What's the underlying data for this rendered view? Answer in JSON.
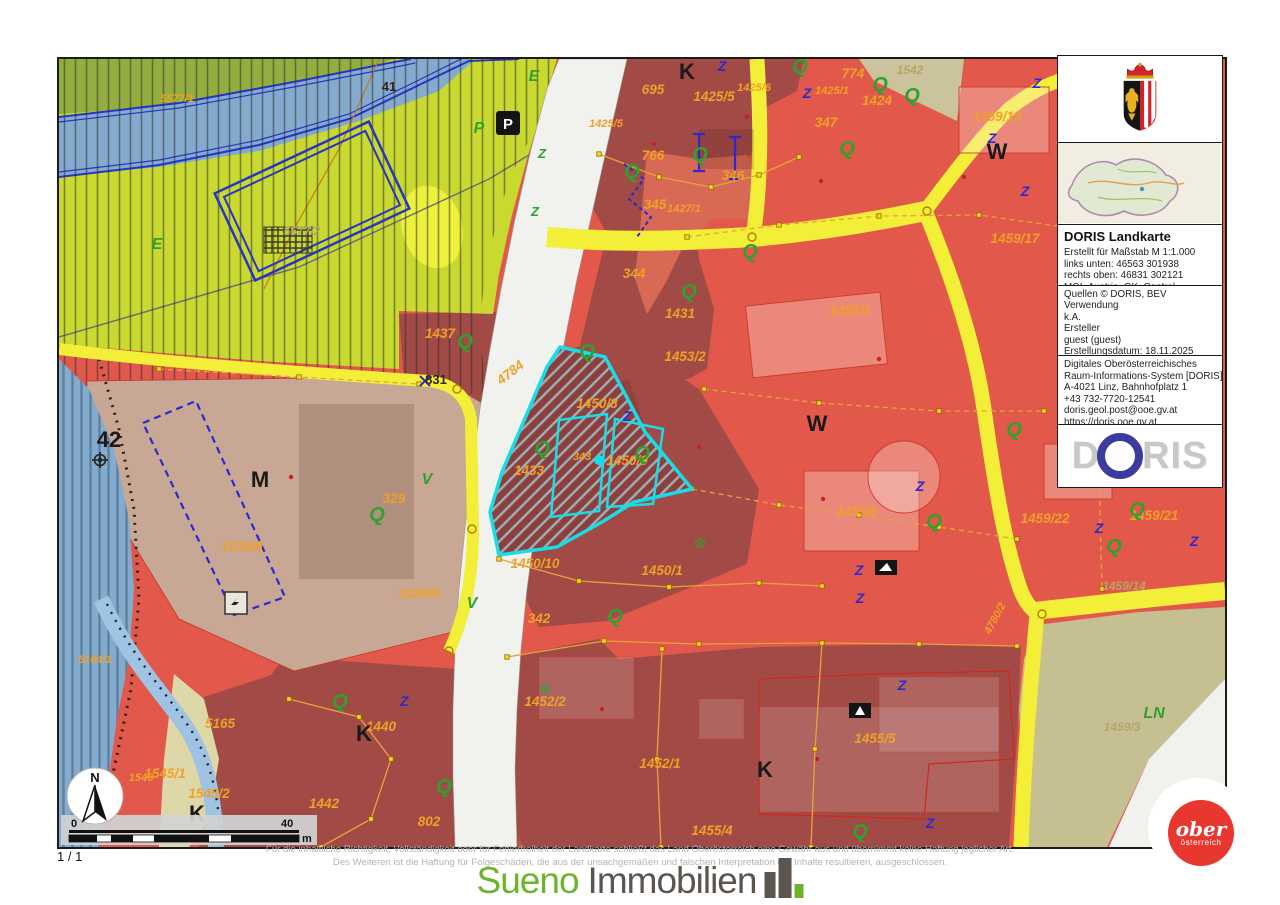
{
  "page": {
    "indicator": "1 / 1"
  },
  "panel": {
    "title": "DORIS Landkarte",
    "meta_lines": [
      "Erstellt für Maßstab M 1:1.000",
      "links unten: 46563 301938",
      "rechts oben: 46831 302121",
      "MGI_Austria_GK_Central"
    ],
    "source_lines": [
      "Quellen © DORIS, BEV",
      "Verwendung",
      "k.A.",
      "Ersteller",
      "guest (guest)",
      "Erstellungsdatum: 18.11.2025"
    ],
    "org_lines": [
      "Digitales Oberösterreichisches",
      "Raum-Informations-System [DORIS]",
      "A-4021 Linz, Bahnhofplatz 1",
      "+43 732-7720-12541",
      "doris.geol.post@ooe.gv.at",
      "https://doris.ooe.gv.at"
    ],
    "logo": {
      "d": "D",
      "ris": "RIS"
    }
  },
  "footer": {
    "disclaimer_line1": "Für die inhaltliche Richtigkeit, Vollständigkeit oder für Fehlerfreiheit der Landkarte schließt das Land Oberösterreich eine Gewähr aus und übernimmt keine Haftung jeglicher Art.",
    "disclaimer_line2": "Des Weiteren ist die Haftung für Folgeschäden, die aus der unsachgemäßen und falschen Interpretation der Inhalte resultieren, ausgeschlossen.",
    "watermark_primary": "Sueno",
    "watermark_secondary": "Immobilien"
  },
  "corner_logo": {
    "line1": "ober",
    "line2": "österreich"
  },
  "scalebar": {
    "start": "0",
    "end": "40",
    "unit": "m"
  },
  "north": {
    "label": "N"
  },
  "map": {
    "colors": {
      "light_parcel_red": "#e2584a",
      "dark_parcel_red": "#a24b46",
      "land_green": "#c9d92f",
      "water_blue": "#84abcd",
      "beige": "#c8a795",
      "olive_field": "#c5bf92",
      "road_yellow": "#f3ef39",
      "road_white": "#f1f1ee",
      "highlight_cyan": "#17dde8",
      "parcel_label_orange": "#f0a028",
      "symbol_green": "#2fa12f",
      "symbol_blue": "#2a2ad0",
      "crest_red": "#d2232a",
      "corner_logo_red": "#e8372e",
      "sueno_green": "#6bb52c"
    },
    "labels": [
      {
        "t": "5577/1",
        "x": 118,
        "y": 43,
        "c": "ps"
      },
      {
        "t": "695",
        "x": 594,
        "y": 35,
        "c": "p"
      },
      {
        "t": "1425/5",
        "x": 655,
        "y": 42,
        "c": "p"
      },
      {
        "t": "1425/5",
        "x": 547,
        "y": 68,
        "c": "ps"
      },
      {
        "t": "1425/6",
        "x": 695,
        "y": 32,
        "c": "ps"
      },
      {
        "t": "1425/1",
        "x": 773,
        "y": 35,
        "c": "ps"
      },
      {
        "t": "774",
        "x": 794,
        "y": 19,
        "c": "p"
      },
      {
        "t": "1424",
        "x": 818,
        "y": 46,
        "c": "p"
      },
      {
        "t": "347",
        "x": 767,
        "y": 68,
        "c": "p"
      },
      {
        "t": "766",
        "x": 594,
        "y": 101,
        "c": "p"
      },
      {
        "t": "346",
        "x": 674,
        "y": 121,
        "c": "p"
      },
      {
        "t": "345",
        "x": 596,
        "y": 150,
        "c": "p"
      },
      {
        "t": "1427/1",
        "x": 625,
        "y": 153,
        "c": "ps"
      },
      {
        "t": "344",
        "x": 575,
        "y": 219,
        "c": "p"
      },
      {
        "t": "1431",
        "x": 621,
        "y": 259,
        "c": "p"
      },
      {
        "t": "1453/2",
        "x": 626,
        "y": 302,
        "c": "p"
      },
      {
        "t": "1455/1",
        "x": 791,
        "y": 256,
        "c": "p"
      },
      {
        "t": "1437",
        "x": 381,
        "y": 279,
        "c": "p"
      },
      {
        "t": "4784",
        "x": 454,
        "y": 317,
        "c": "p",
        "r": -38
      },
      {
        "t": "1450/8",
        "x": 538,
        "y": 349,
        "c": "p"
      },
      {
        "t": "343",
        "x": 523,
        "y": 401,
        "c": "ps"
      },
      {
        "t": "1450/9",
        "x": 568,
        "y": 406,
        "c": "p"
      },
      {
        "t": "1433",
        "x": 470,
        "y": 416,
        "c": "p"
      },
      {
        "t": "1459/15",
        "x": 938,
        "y": 62,
        "c": "p"
      },
      {
        "t": "1459/17",
        "x": 956,
        "y": 184,
        "c": "p"
      },
      {
        "t": "329",
        "x": 335,
        "y": 444,
        "c": "p"
      },
      {
        "t": "1439/9",
        "x": 183,
        "y": 492,
        "c": "p"
      },
      {
        "t": "1439/8",
        "x": 360,
        "y": 539,
        "c": "p"
      },
      {
        "t": "1450/10",
        "x": 476,
        "y": 509,
        "c": "p"
      },
      {
        "t": "1450/1",
        "x": 603,
        "y": 516,
        "c": "p"
      },
      {
        "t": "342",
        "x": 480,
        "y": 564,
        "c": "p"
      },
      {
        "t": "1455/6",
        "x": 798,
        "y": 457,
        "c": "p"
      },
      {
        "t": "1459/22",
        "x": 986,
        "y": 464,
        "c": "p"
      },
      {
        "t": "1459/21",
        "x": 1095,
        "y": 461,
        "c": "p"
      },
      {
        "t": "4780/2",
        "x": 939,
        "y": 561,
        "c": "ps",
        "r": -62
      },
      {
        "t": "5164/1",
        "x": 36,
        "y": 604,
        "c": "ps"
      },
      {
        "t": "5165",
        "x": 161,
        "y": 669,
        "c": "p"
      },
      {
        "t": "1545/1",
        "x": 106,
        "y": 719,
        "c": "p"
      },
      {
        "t": "1545/2",
        "x": 150,
        "y": 739,
        "c": "p"
      },
      {
        "t": "1546",
        "x": 82,
        "y": 722,
        "c": "ps"
      },
      {
        "t": "1442",
        "x": 265,
        "y": 749,
        "c": "p"
      },
      {
        "t": "1440",
        "x": 322,
        "y": 672,
        "c": "p"
      },
      {
        "t": "802",
        "x": 370,
        "y": 767,
        "c": "p"
      },
      {
        "t": "1452/2",
        "x": 486,
        "y": 647,
        "c": "p"
      },
      {
        "t": "1452/1",
        "x": 601,
        "y": 709,
        "c": "p"
      },
      {
        "t": "1455/5",
        "x": 816,
        "y": 684,
        "c": "p"
      },
      {
        "t": "1455/4",
        "x": 653,
        "y": 776,
        "c": "p"
      },
      {
        "t": "5577/2",
        "x": 243,
        "y": 176,
        "c": "ol"
      },
      {
        "t": "1542",
        "x": 851,
        "y": 15,
        "c": "ol"
      },
      {
        "t": "1459/14",
        "x": 1065,
        "y": 531,
        "c": "ol"
      },
      {
        "t": "1459/3",
        "x": 1063,
        "y": 672,
        "c": "ol"
      },
      {
        "t": "831",
        "x": 377,
        "y": 325,
        "c": "dk"
      },
      {
        "t": "41",
        "x": 330,
        "y": 32,
        "c": "dk"
      },
      {
        "t": "K",
        "x": 628,
        "y": 20,
        "c": "blk"
      },
      {
        "t": "W",
        "x": 938,
        "y": 100,
        "c": "blk"
      },
      {
        "t": "W",
        "x": 758,
        "y": 372,
        "c": "blk"
      },
      {
        "t": "M",
        "x": 201,
        "y": 428,
        "c": "blk"
      },
      {
        "t": "K",
        "x": 305,
        "y": 682,
        "c": "blk"
      },
      {
        "t": "K",
        "x": 706,
        "y": 718,
        "c": "blk"
      },
      {
        "t": "K",
        "x": 138,
        "y": 762,
        "c": "blk",
        "s": 18
      },
      {
        "t": "42",
        "x": 50,
        "y": 388,
        "c": "blk",
        "s": 16
      },
      {
        "t": "E",
        "x": 98,
        "y": 190,
        "c": "grn",
        "s": 18
      },
      {
        "t": "E",
        "x": 475,
        "y": 22,
        "c": "grn",
        "s": 14
      },
      {
        "t": "P",
        "x": 420,
        "y": 74,
        "c": "grn",
        "s": 16
      },
      {
        "t": "V",
        "x": 368,
        "y": 425,
        "c": "grn",
        "s": 14
      },
      {
        "t": "V",
        "x": 413,
        "y": 549,
        "c": "grn",
        "s": 14
      },
      {
        "t": "LN",
        "x": 1095,
        "y": 659,
        "c": "grn",
        "s": 17
      },
      {
        "t": "P",
        "x": 449,
        "y": 70,
        "c": "pw"
      },
      {
        "t": "Q",
        "x": 741,
        "y": 14,
        "c": "q"
      },
      {
        "t": "Q",
        "x": 821,
        "y": 32,
        "c": "q"
      },
      {
        "t": "Q",
        "x": 853,
        "y": 43,
        "c": "q",
        "s": 15
      },
      {
        "t": "Q",
        "x": 788,
        "y": 96,
        "c": "q"
      },
      {
        "t": "Q",
        "x": 641,
        "y": 102,
        "c": "q"
      },
      {
        "t": "Q",
        "x": 573,
        "y": 119,
        "c": "q"
      },
      {
        "t": "Q",
        "x": 691,
        "y": 199,
        "c": "q"
      },
      {
        "t": "Q",
        "x": 630,
        "y": 239,
        "c": "q"
      },
      {
        "t": "Q",
        "x": 528,
        "y": 299,
        "c": "q"
      },
      {
        "t": "Q",
        "x": 483,
        "y": 396,
        "c": "q"
      },
      {
        "t": "Q",
        "x": 583,
        "y": 401,
        "c": "q"
      },
      {
        "t": "Q",
        "x": 955,
        "y": 377,
        "c": "q"
      },
      {
        "t": "Q",
        "x": 875,
        "y": 469,
        "c": "q"
      },
      {
        "t": "Q",
        "x": 1078,
        "y": 457,
        "c": "q"
      },
      {
        "t": "Q",
        "x": 1055,
        "y": 494,
        "c": "q"
      },
      {
        "t": "Q",
        "x": 556,
        "y": 564,
        "c": "q"
      },
      {
        "t": "Q",
        "x": 281,
        "y": 649,
        "c": "q"
      },
      {
        "t": "Q",
        "x": 385,
        "y": 734,
        "c": "q"
      },
      {
        "t": "Q",
        "x": 801,
        "y": 779,
        "c": "q"
      },
      {
        "t": "Q",
        "x": 406,
        "y": 289,
        "c": "q",
        "s": 16
      },
      {
        "t": "Q",
        "x": 318,
        "y": 462,
        "c": "q",
        "s": 16
      },
      {
        "t": "⊛",
        "x": 641,
        "y": 489,
        "c": "qs"
      },
      {
        "t": "⊛",
        "x": 486,
        "y": 635,
        "c": "qs"
      },
      {
        "t": "Z",
        "x": 663,
        "y": 12,
        "c": "z"
      },
      {
        "t": "Z",
        "x": 748,
        "y": 39,
        "c": "z"
      },
      {
        "t": "Z",
        "x": 933,
        "y": 84,
        "c": "z"
      },
      {
        "t": "Z",
        "x": 978,
        "y": 29,
        "c": "z"
      },
      {
        "t": "Z",
        "x": 966,
        "y": 137,
        "c": "z"
      },
      {
        "t": "Z",
        "x": 568,
        "y": 362,
        "c": "z"
      },
      {
        "t": "Z",
        "x": 861,
        "y": 432,
        "c": "z"
      },
      {
        "t": "Z",
        "x": 1040,
        "y": 474,
        "c": "z"
      },
      {
        "t": "Z",
        "x": 1135,
        "y": 487,
        "c": "z"
      },
      {
        "t": "Z",
        "x": 800,
        "y": 516,
        "c": "z"
      },
      {
        "t": "Z",
        "x": 801,
        "y": 544,
        "c": "z"
      },
      {
        "t": "Z",
        "x": 843,
        "y": 631,
        "c": "z"
      },
      {
        "t": "Z",
        "x": 871,
        "y": 769,
        "c": "z"
      },
      {
        "t": "Z",
        "x": 345,
        "y": 647,
        "c": "z"
      },
      {
        "t": "Z",
        "x": 476,
        "y": 157,
        "c": "zg"
      },
      {
        "t": "Z",
        "x": 483,
        "y": 99,
        "c": "zg"
      }
    ],
    "parcel_lines": [
      {
        "pts": [
          [
            540,
            95
          ],
          [
            600,
            118
          ],
          [
            652,
            128
          ],
          [
            700,
            116
          ],
          [
            740,
            98
          ]
        ]
      },
      {
        "pts": [
          [
            628,
            178
          ],
          [
            720,
            166
          ],
          [
            820,
            157
          ],
          [
            920,
            156
          ],
          [
            1005,
            168
          ]
        ],
        "dash": true
      },
      {
        "pts": [
          [
            645,
            330
          ],
          [
            760,
            344
          ],
          [
            880,
            352
          ],
          [
            985,
            352
          ]
        ],
        "dash": true
      },
      {
        "pts": [
          [
            633,
            430
          ],
          [
            720,
            446
          ],
          [
            800,
            456
          ],
          [
            880,
            468
          ],
          [
            958,
            480
          ]
        ],
        "dash": true
      },
      {
        "pts": [
          [
            440,
            500
          ],
          [
            520,
            522
          ],
          [
            610,
            528
          ],
          [
            700,
            524
          ],
          [
            763,
            527
          ]
        ]
      },
      {
        "pts": [
          [
            448,
            598
          ],
          [
            545,
            582
          ],
          [
            640,
            585
          ],
          [
            763,
            584
          ],
          [
            860,
            585
          ],
          [
            958,
            587
          ]
        ]
      },
      {
        "pts": [
          [
            763,
            584
          ],
          [
            756,
            690
          ],
          [
            752,
            788
          ]
        ]
      },
      {
        "pts": [
          [
            603,
            590
          ],
          [
            598,
            700
          ],
          [
            602,
            788
          ]
        ]
      },
      {
        "pts": [
          [
            1040,
            415
          ],
          [
            1043,
            530
          ]
        ],
        "dash": true
      },
      {
        "pts": [
          [
            230,
            640
          ],
          [
            300,
            658
          ],
          [
            332,
            700
          ],
          [
            312,
            760
          ],
          [
            262,
            788
          ]
        ]
      },
      {
        "pts": [
          [
            100,
            310
          ],
          [
            240,
            318
          ],
          [
            360,
            325
          ]
        ],
        "dash": true
      }
    ],
    "junctions": [
      [
        693,
        178
      ],
      [
        868,
        152
      ],
      [
        983,
        555
      ],
      [
        398,
        330
      ],
      [
        413,
        470
      ],
      [
        390,
        592
      ]
    ]
  }
}
